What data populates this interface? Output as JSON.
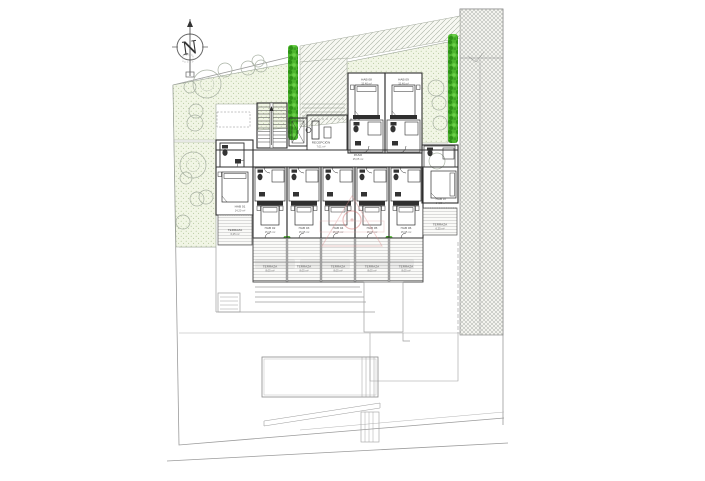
{
  "compass": {
    "letter": "N"
  },
  "labels": {
    "corridor": {
      "name": "PASO",
      "area": "25,05 m²"
    },
    "reception": {
      "name": "RECEPCIÓN",
      "area": "7,01 m²"
    },
    "top_rooms": [
      {
        "name": "HAB 08",
        "area": "15,40 m²"
      },
      {
        "name": "HAB 09",
        "area": "15,40 m²"
      }
    ],
    "left_room": {
      "name": "HAB 01",
      "area": "14,20 m²"
    },
    "right_room": {
      "name": "HAB 07",
      "area": "14,20 m²"
    },
    "bottom_rooms": [
      {
        "name": "HAB 02",
        "area": "15,05 m²"
      },
      {
        "name": "HAB 03",
        "area": "15,05 m²"
      },
      {
        "name": "HAB 04",
        "area": "15,05 m²"
      },
      {
        "name": "HAB 05",
        "area": "15,05 m²"
      },
      {
        "name": "HAB 06",
        "area": "15,05 m²"
      }
    ],
    "side_terraces": [
      {
        "name": "TERRAZA",
        "area": "6,25 m²"
      },
      {
        "name": "TERRAZA",
        "area": "6,25 m²"
      }
    ],
    "terraces": [
      {
        "name": "TERRAZA",
        "area": "8,05 m²"
      },
      {
        "name": "TERRAZA",
        "area": "8,05 m²"
      },
      {
        "name": "TERRAZA",
        "area": "8,05 m²"
      },
      {
        "name": "TERRAZA",
        "area": "8,05 m²"
      },
      {
        "name": "TERRAZA",
        "area": "8,05 m²"
      }
    ]
  },
  "colors": {
    "hedge_green": "#4db62e",
    "garden_fill": "#f1f5e5",
    "watermark_red": "#cf5f5f",
    "lot_line": "#9b9b9b",
    "wall": "#2f2f2f"
  }
}
